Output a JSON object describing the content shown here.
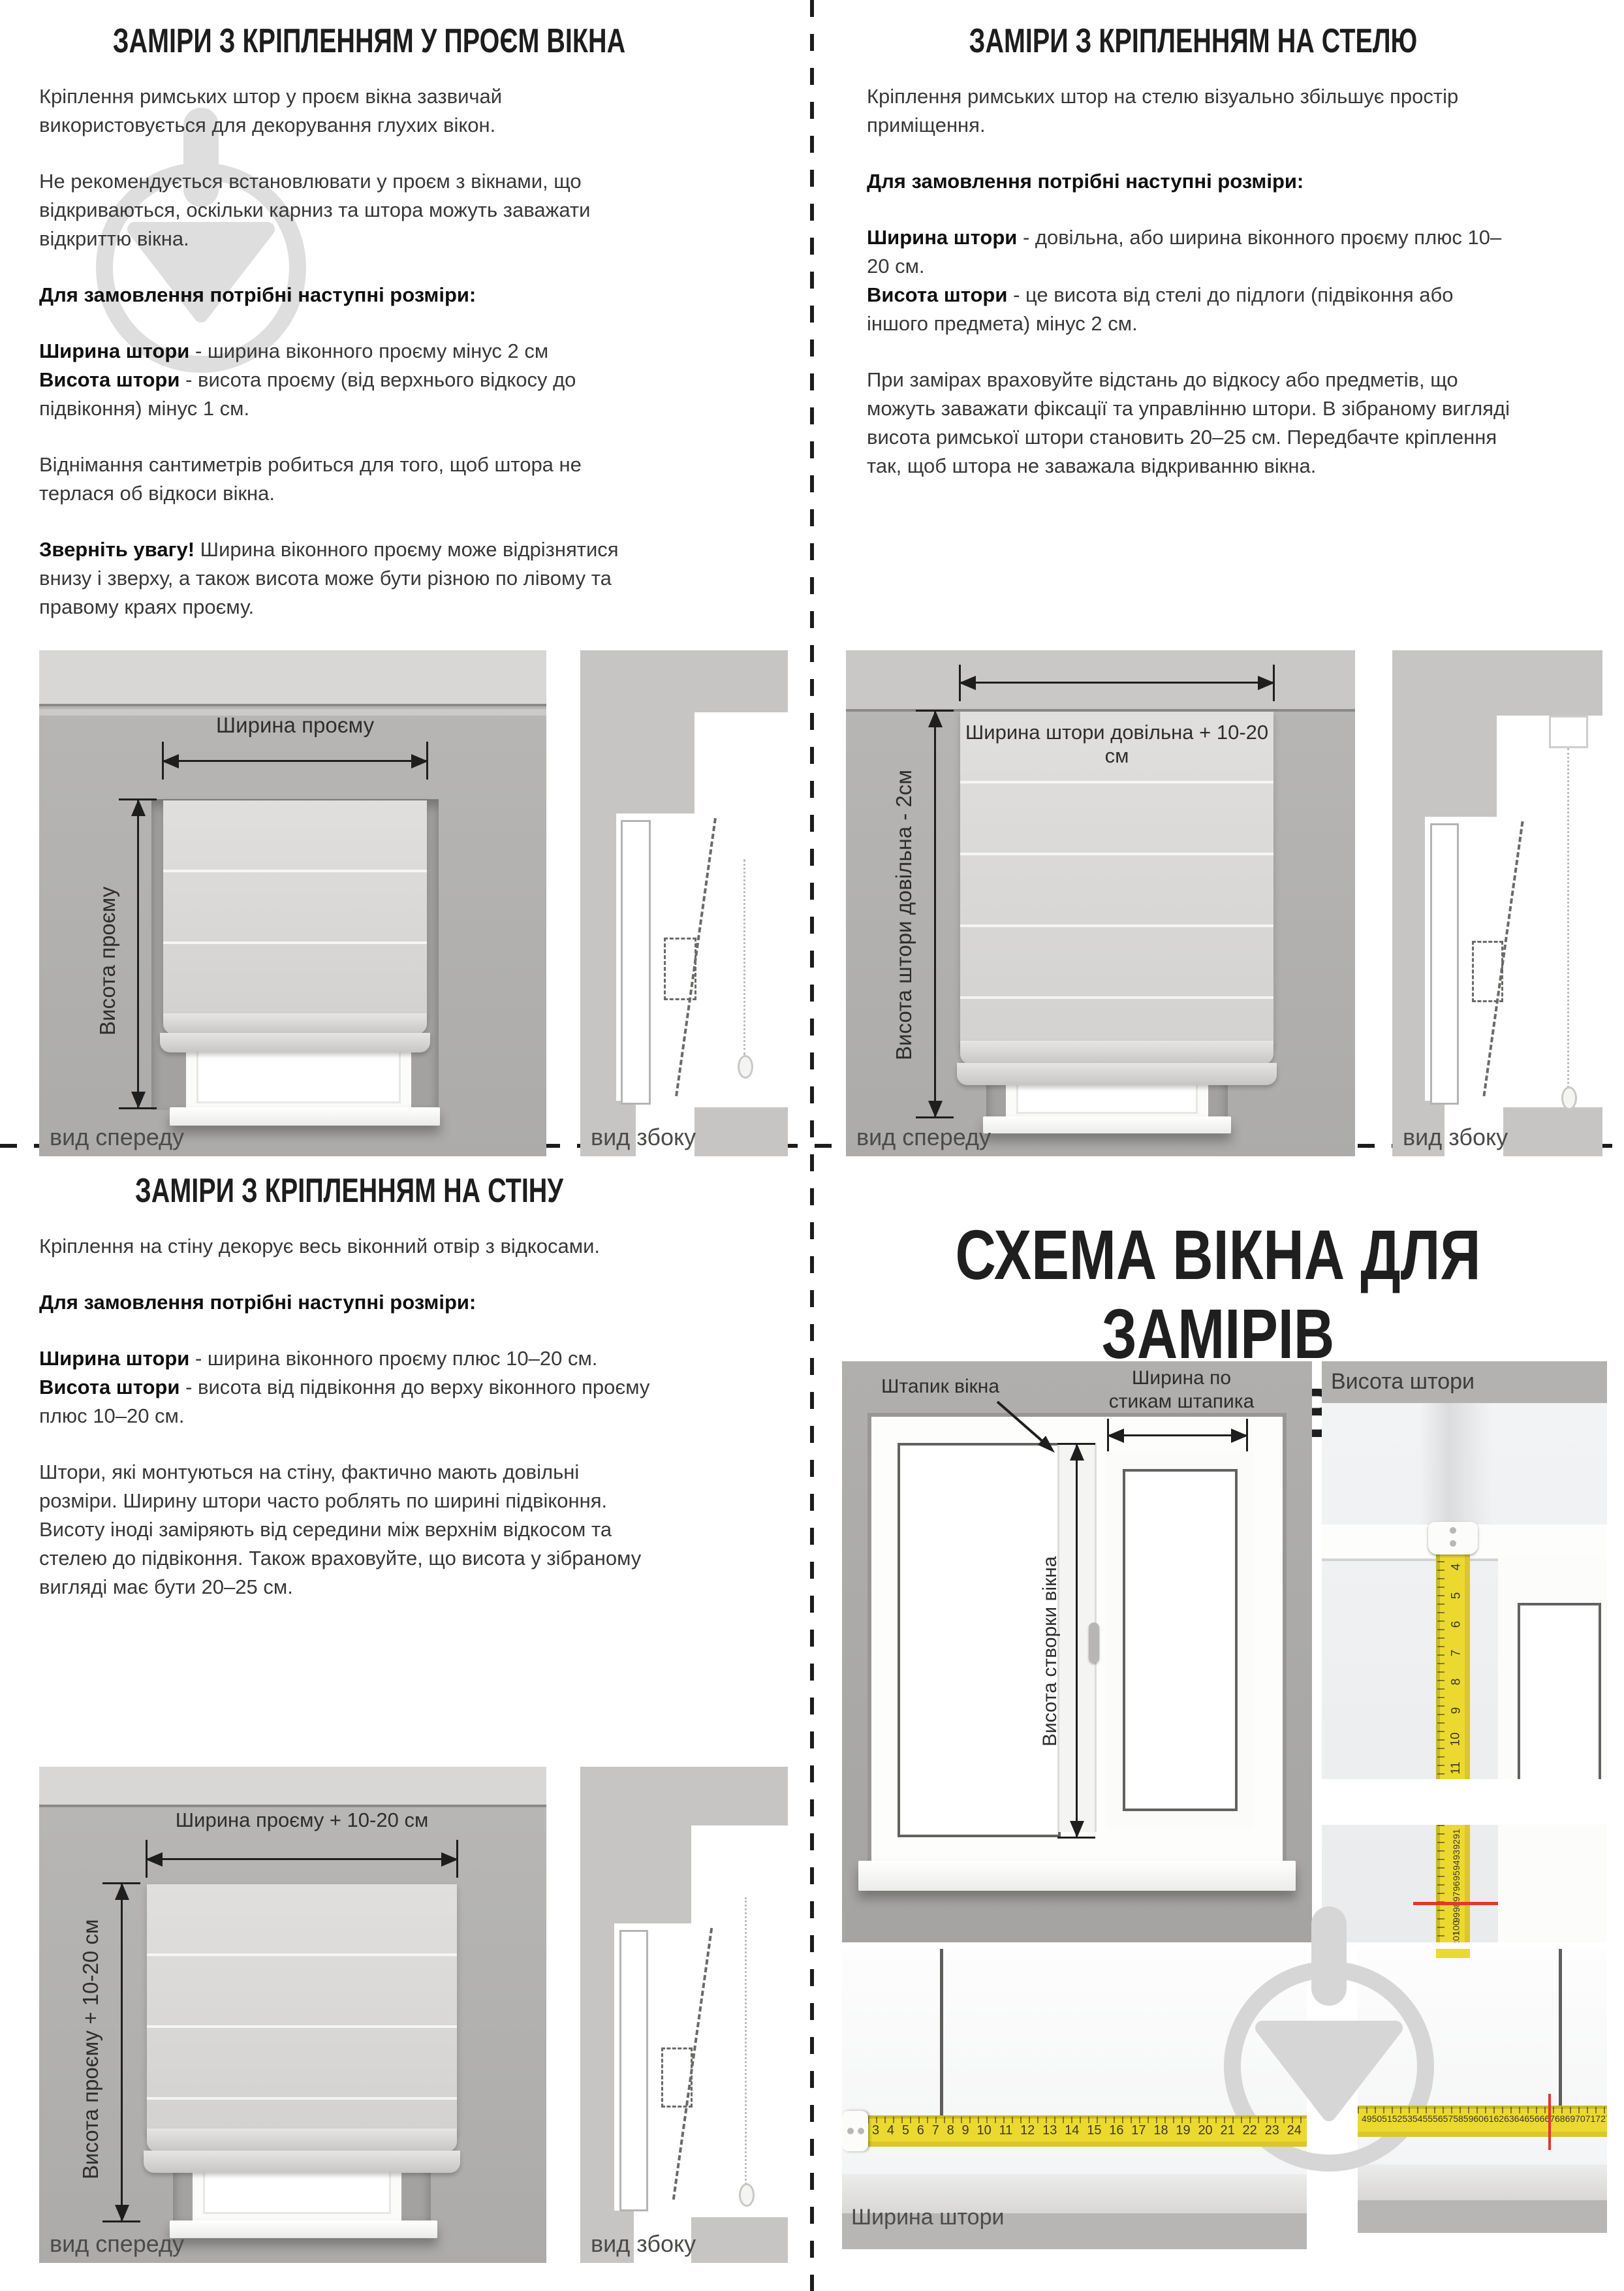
{
  "opening": {
    "title": "ЗАМІРИ З КРІПЛЕННЯМ У ПРОЄМ ВІКНА",
    "intro": "Кріплення римських штор у проєм вікна зазвичай використовується для декорування глухих вікон.",
    "warning": "Не рекомендується встановлювати у проєм з вікнами, що відкриваються, оскільки карниз та штора можуть заважати відкриттю вікна.",
    "order_heading": "Для замовлення потрібні наступні розміри:",
    "width_term": "Ширина штори",
    "width_def": "- ширина віконного проєму мінус 2 см",
    "height_term": "Висота штори",
    "height_def": "- висота проєму (від верхнього відкосу до підвіконня) мінус 1 см.",
    "subtract_note": "Віднімання сантиметрів робиться для того, щоб штора не терлася об відкоси вікна.",
    "attention_term": "Зверніть увагу!",
    "attention_text": "Ширина віконного проєму може відрізнятися внизу і зверху, а також висота може бути різною по лівому та правому краях проєму.",
    "figure": {
      "width_label": "Ширина проєму",
      "height_label": "Висота проєму",
      "front_caption": "вид спереду",
      "side_caption": "вид збоку"
    }
  },
  "ceiling": {
    "title": "ЗАМІРИ З КРІПЛЕННЯМ НА СТЕЛЮ",
    "intro": "Кріплення римських штор на стелю візуально збільшує простір приміщення.",
    "order_heading": "Для замовлення потрібні наступні розміри:",
    "width_term": "Ширина штори",
    "width_def": "- довільна, або ширина віконного проєму плюс 10–20 см.",
    "height_term": "Висота штори",
    "height_def": "- це висота від стелі до підлоги (підвіконня або іншого предмета) мінус 2 см.",
    "measuring_note": "При замірах враховуйте відстань до відкосу або предметів, що можуть заважати фіксації та управлінню штори. В зібраному вигляді висота римської штори становить 20–25 см. Передбачте кріплення так, щоб штора не заважала відкриванню вікна.",
    "figure": {
      "width_label": "Ширина штори довільна + 10-20 см",
      "height_label": "Висота штори довільна - 2см",
      "front_caption": "вид спереду",
      "side_caption": "вид збоку"
    }
  },
  "wall": {
    "title": "ЗАМІРИ З КРІПЛЕННЯМ НА СТІНУ",
    "intro": "Кріплення на стіну декорує весь віконний отвір з відкосами.",
    "order_heading": "Для замовлення потрібні наступні розміри:",
    "width_term": "Ширина штори",
    "width_def": "- ширина віконного проєму плюс 10–20 см.",
    "height_term": "Висота штори",
    "height_def": "- висота від підвіконня до верху віконного проєму плюс 10–20 см.",
    "sizing_note": "Штори, які монтуються на стіну, фактично мають довільні розміри. Ширину штори часто роблять по ширині підвіконня. Висоту іноді заміряють від середини між верхнім відкосом та стелею до підвіконня. Також враховуйте, що висота у зібраному вигляді має бути 20–25 см.",
    "figure": {
      "width_label": "Ширина проєму + 10-20 см",
      "height_label": "Висота проєму + 10-20 см",
      "front_caption": "вид спереду",
      "side_caption": "вид збоку"
    }
  },
  "sash": {
    "title_line1": "СХЕМА ВІКНА ДЛЯ ЗАМІРІВ",
    "title_line2": "НА СТУЛКУ ВІКНА",
    "bead_label": "Штапик вікна",
    "bead_width_label": "Ширина по стикам штапика",
    "sash_height_label": "Висота створки вікна",
    "curtain_height_label": "Висота штори",
    "curtain_width_label": "Ширина штори",
    "tape_vertical_top": [
      "3",
      "4",
      "5",
      "6",
      "7",
      "8",
      "9",
      "10",
      "11"
    ],
    "tape_vertical_bottom": [
      "91",
      "92",
      "93",
      "94",
      "95",
      "96",
      "97",
      "98",
      "99",
      "100",
      "101",
      "102",
      "103",
      "104",
      "105",
      "106",
      "107",
      "108",
      "109",
      "110"
    ],
    "tape_horizontal_left": [
      "3",
      "4",
      "5",
      "6",
      "7",
      "8",
      "9",
      "10",
      "11",
      "12",
      "13",
      "14",
      "15",
      "16",
      "17",
      "18",
      "19",
      "20",
      "21",
      "22",
      "23",
      "24"
    ],
    "tape_horizontal_right": [
      "49",
      "50",
      "51",
      "52",
      "53",
      "54",
      "55",
      "56",
      "57",
      "58",
      "59",
      "60",
      "61",
      "62",
      "63",
      "64",
      "65",
      "66",
      "67",
      "68",
      "69",
      "70",
      "71",
      "72",
      "73",
      "74",
      "75",
      "76",
      "77",
      "78",
      "79",
      "80"
    ]
  }
}
